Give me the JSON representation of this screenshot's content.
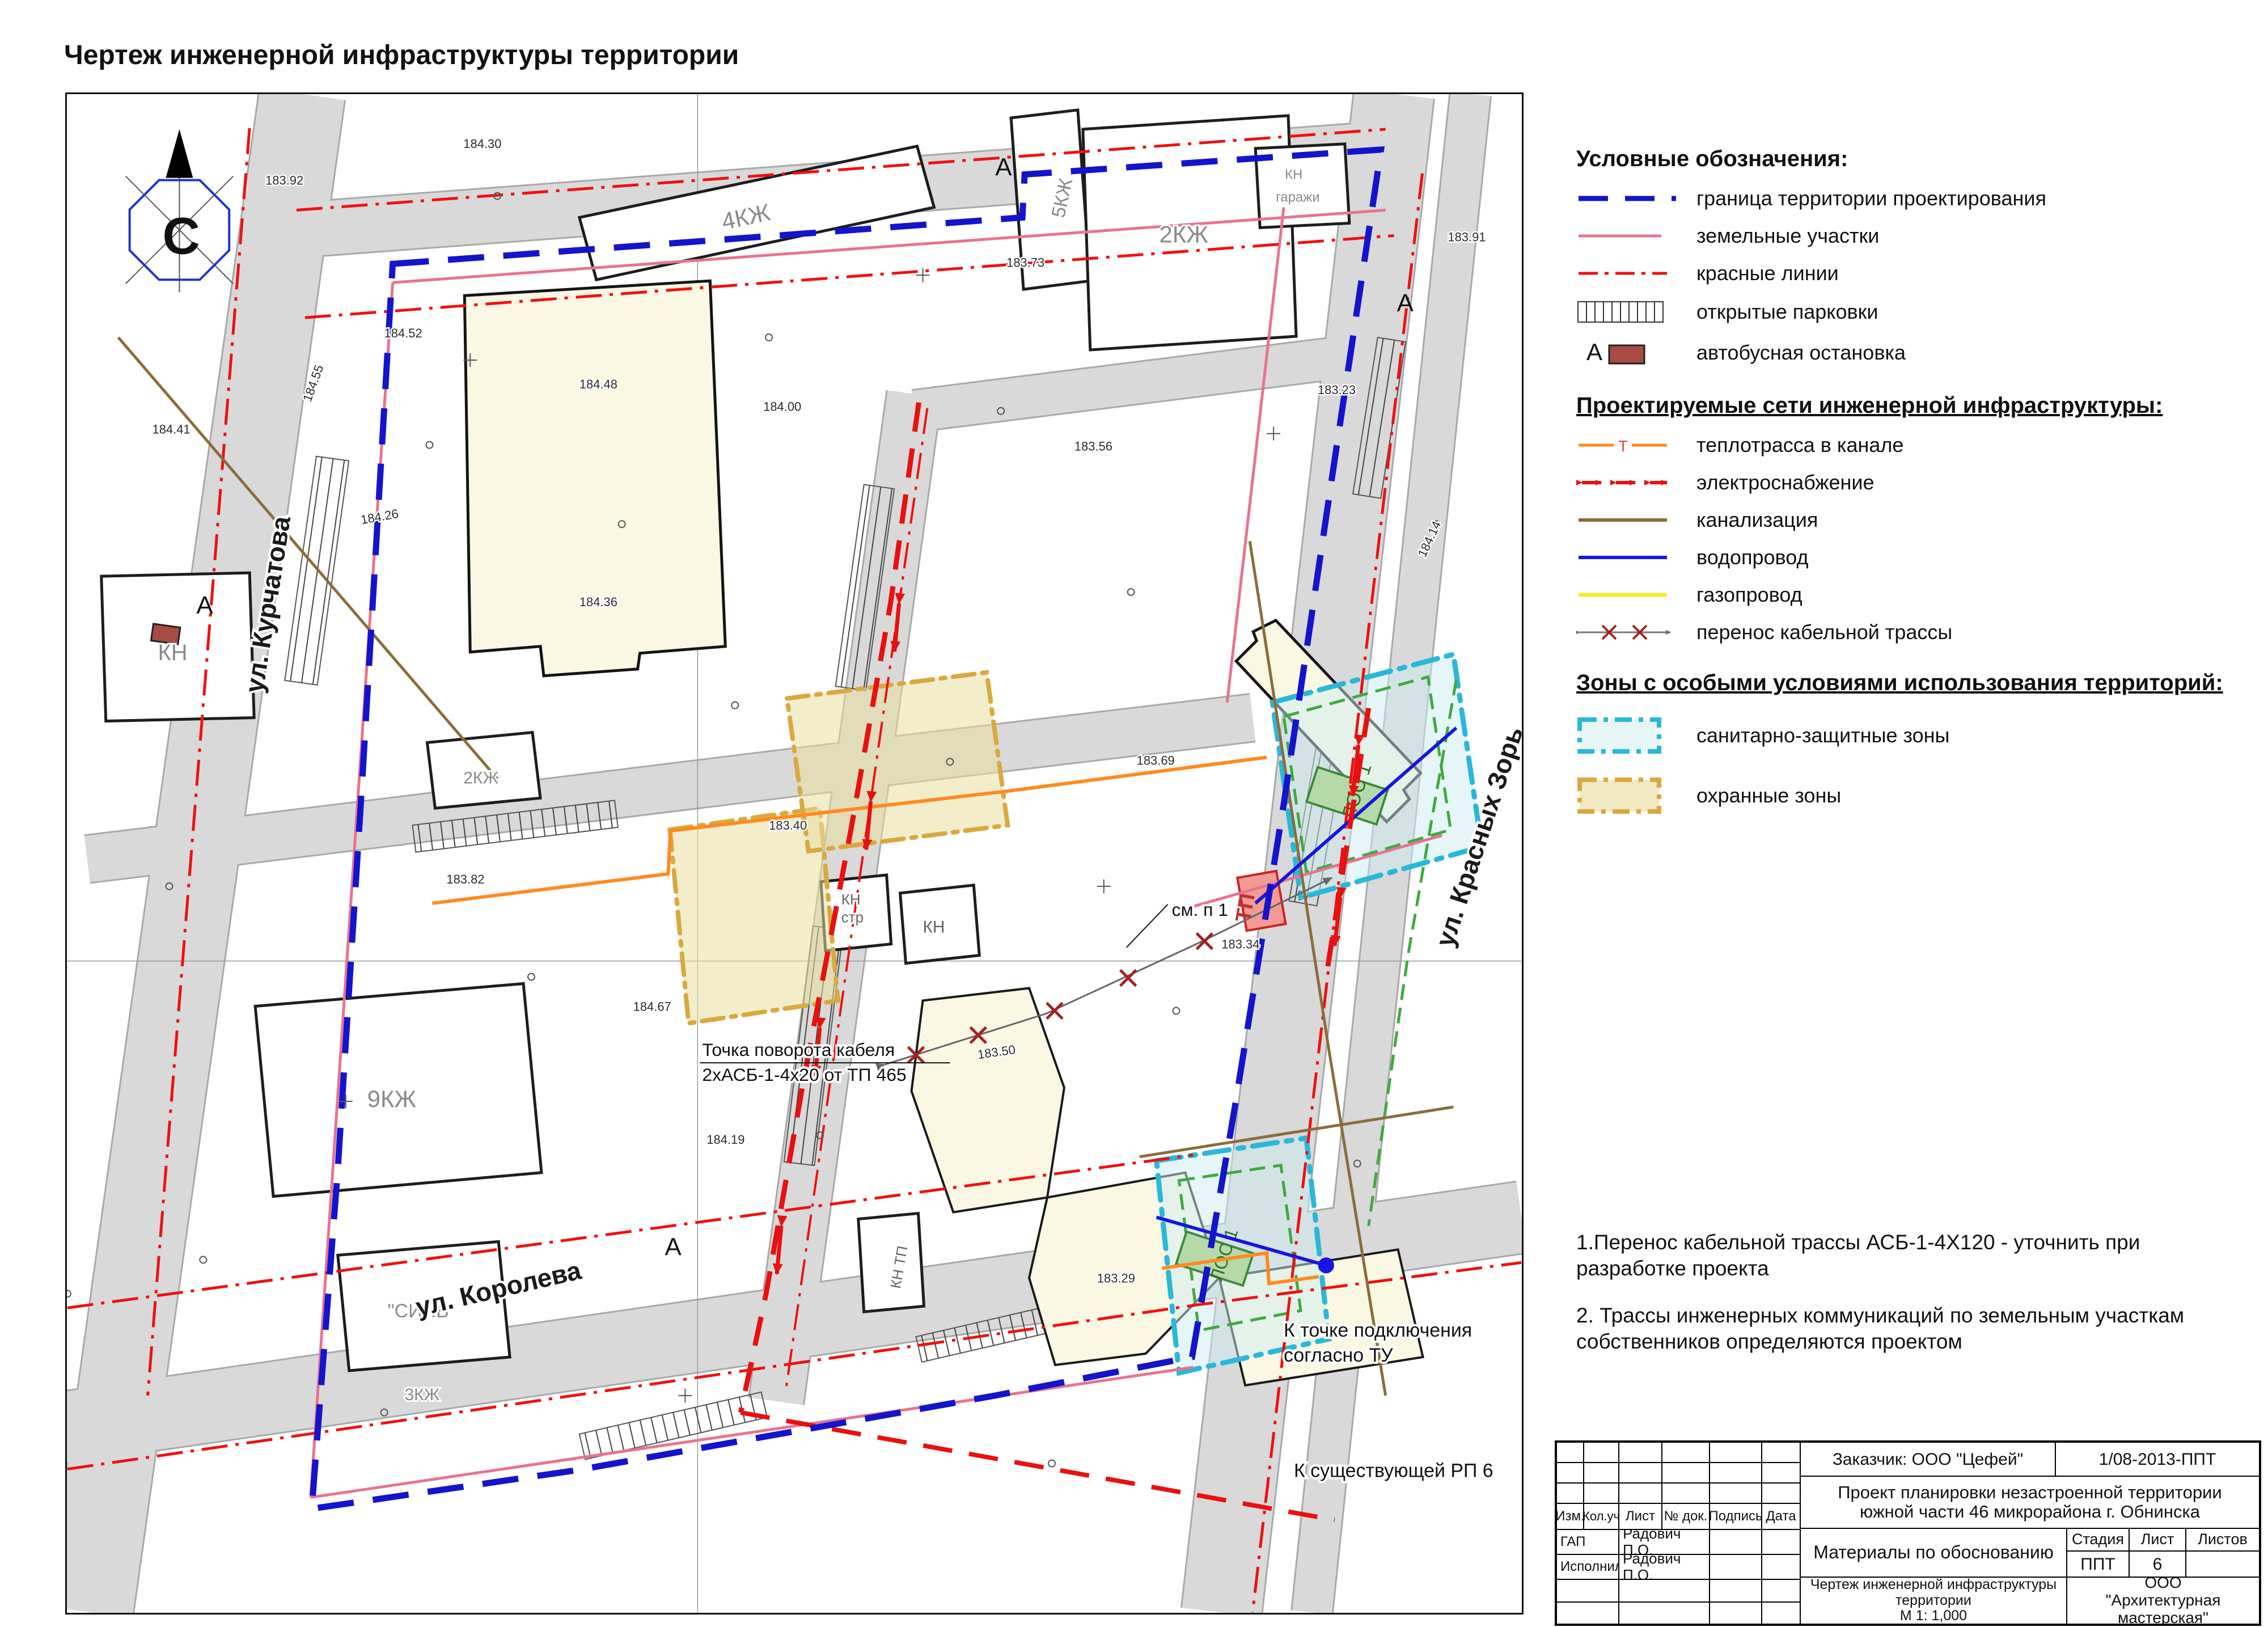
{
  "page": {
    "title": "Чертеж инженерной инфраструктуры территории"
  },
  "legend": {
    "section1_title": "Условные обозначения:",
    "items1": [
      {
        "symbol": "boundary-line",
        "label": "граница территории проектирования"
      },
      {
        "symbol": "parcel-line",
        "label": "земельные участки"
      },
      {
        "symbol": "red-line",
        "label": "красные линии"
      },
      {
        "symbol": "parking-hatch",
        "label": "открытые парковки"
      },
      {
        "symbol": "bus-stop",
        "label": "автобусная остановка",
        "marker_letter": "А"
      }
    ],
    "section2_title": "Проектируемые сети инженерной инфраструктуры:",
    "items2": [
      {
        "symbol": "heat-line",
        "label": "теплотрасса в канале",
        "marker_letter": "Т"
      },
      {
        "symbol": "power-line",
        "label": "электроснабжение"
      },
      {
        "symbol": "sewer-line",
        "label": "канализация"
      },
      {
        "symbol": "water-line",
        "label": "водопровод"
      },
      {
        "symbol": "gas-line",
        "label": "газопровод"
      },
      {
        "symbol": "cable-transfer-line",
        "label": "перенос кабельной трассы"
      }
    ],
    "section3_title": "Зоны с особыми условиями использования территорий:",
    "items3": [
      {
        "symbol": "sanitary-zone",
        "label": "санитарно-защитные зоны"
      },
      {
        "symbol": "guard-zone",
        "label": "охранные зоны"
      }
    ]
  },
  "notes": {
    "note1": "1.Перенос кабельной трассы  АСБ-1-4Х120 - уточнить при разработке проекта",
    "note2": "2. Трассы инженерных коммуникаций по земельным участкам собственников определяются проектом"
  },
  "map": {
    "compass_letter": "С",
    "streets": {
      "kurchatova": "ул. Курчатова",
      "koroleva": "ул. Королева",
      "krasnyh_zor": "ул. Красных Зорь"
    },
    "annotations": {
      "cable_turn_line1": "Точка поворота кабеля",
      "cable_turn_line2": "2хАСБ-1-4х20 от ТП 465",
      "see_note": "см. п 1",
      "connection_line1": "К точке подключения",
      "connection_line2": "согласно ТУ",
      "existing_rp": "К существующей РП 6"
    },
    "labels": {
      "bus_letter": "А",
      "kn": "КН",
      "kn_str_line1": "КН",
      "kn_str_line2": "стр",
      "kn_tp": "КН ТП",
      "garage_line1": "КН",
      "garage_line2": "гаражи",
      "tp": "ТП",
      "los": "ЛОС 1",
      "b_2kzh": "2КЖ",
      "b_3kzh": "3КЖ",
      "b_4kzh": "4КЖ",
      "b_5kzh": "5КЖ",
      "b_9kzh": "9КЖ",
      "sinv": "\"СИНВ\""
    },
    "elevations": [
      "184.52",
      "184.48",
      "184.26",
      "184.36",
      "183.92",
      "184.30",
      "183.73",
      "183.91",
      "184.00",
      "183.56",
      "183.34",
      "183.50",
      "184.19",
      "183.82",
      "184.55",
      "184.41",
      "183.23",
      "184.14",
      "183.69",
      "183.40",
      "184.67",
      "183.29"
    ]
  },
  "stamp": {
    "customer": "Заказчик: ООО \"Цефей\"",
    "doc_number": "1/08-2013-ППТ",
    "project_line1": "Проект планировки незастроенной территории",
    "project_line2": "южной части 46 микрорайона г. Обнинска",
    "cols": {
      "izm": "Изм.",
      "koluch": "Кол.уч",
      "list": "Лист",
      "ndok": "№ док.",
      "podpis": "Подпись",
      "data": "Дата"
    },
    "rows": [
      {
        "role": "ГАП",
        "name": "Радович П.О."
      },
      {
        "role": "Исполнил",
        "name": "Радович П.О."
      }
    ],
    "materials": "Материалы по обоснованию",
    "stage_label": "Стадия",
    "sheet_label": "Лист",
    "sheets_label": "Листов",
    "stage": "ППТ",
    "sheet": "6",
    "sheets": "",
    "drawing_title_line1": "Чертеж инженерной инфраструктуры",
    "drawing_title_line2": "территории",
    "scale": "М 1: 1,000",
    "company_line1": "ООО",
    "company_line2": "\"Архитектурная мастерская\""
  }
}
